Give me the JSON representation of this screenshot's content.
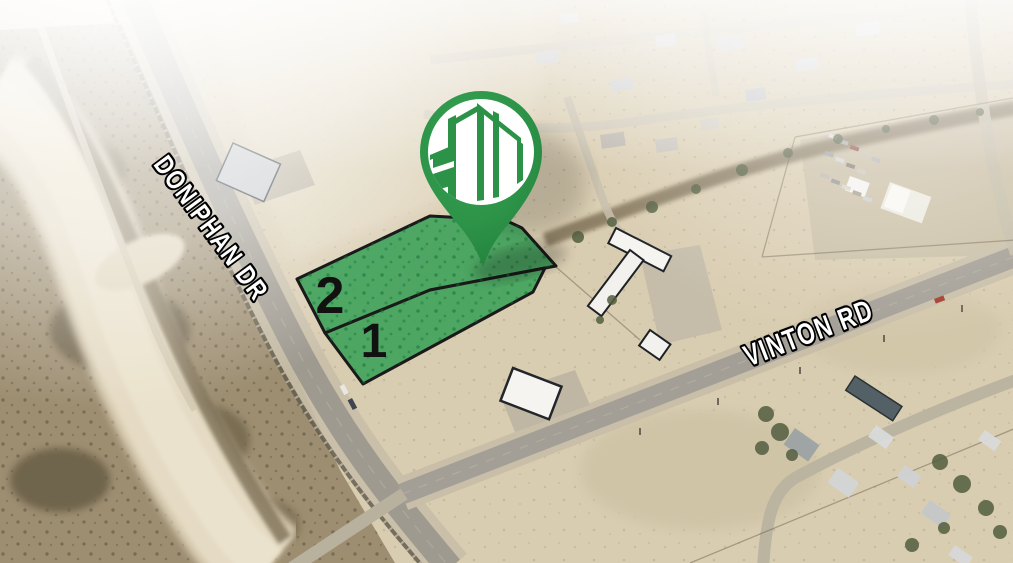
{
  "map": {
    "roads": [
      {
        "label": "DONIPHAN DR"
      },
      {
        "label": "VINTON RD"
      }
    ],
    "parcels": [
      {
        "label": "2"
      },
      {
        "label": "1"
      }
    ],
    "marker": {
      "icon": "city-buildings-pin-icon",
      "pin_color": "#2c9247",
      "logo_background": "#ffffff"
    },
    "colors": {
      "parcel_fill": "#2f9e52",
      "parcel_outline": "#1a1a1a",
      "road_label_fill": "#ffffff",
      "road_label_outline": "#000000",
      "parcel_number_color": "#111111"
    }
  }
}
